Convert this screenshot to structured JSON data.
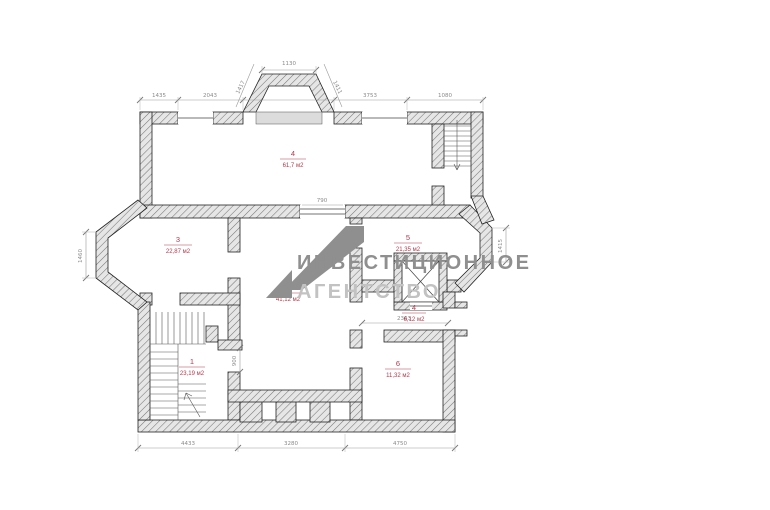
{
  "document": {
    "type": "architectural floor plan drawing",
    "units_note": "м2"
  },
  "watermark": {
    "line1": "ИНВЕСТИЦИОННОЕ",
    "line2": "АГЕНТСТВО",
    "logo": "stylized-A-mark"
  },
  "rooms": [
    {
      "number": "4",
      "area": "61,7 м2"
    },
    {
      "number": "3",
      "area": "22,87 м2"
    },
    {
      "number": "2",
      "area": "41,12 м2"
    },
    {
      "number": "5",
      "area": "21,35 м2"
    },
    {
      "number": "4",
      "area": "6,12 м2"
    },
    {
      "number": "6",
      "area": "11,32 м2"
    },
    {
      "number": "1",
      "area": "23,19 м2"
    }
  ],
  "dimensions": [
    {
      "text": "1130",
      "x": 289,
      "y": 65,
      "rotate": 0
    },
    {
      "text": "1417",
      "x": 242,
      "y": 88,
      "rotate": -64
    },
    {
      "text": "1411",
      "x": 336,
      "y": 88,
      "rotate": 64
    },
    {
      "text": "1435",
      "x": 159,
      "y": 97,
      "rotate": 0
    },
    {
      "text": "2043",
      "x": 210,
      "y": 97,
      "rotate": 0
    },
    {
      "text": "3753",
      "x": 370,
      "y": 97,
      "rotate": 0
    },
    {
      "text": "1080",
      "x": 445,
      "y": 97,
      "rotate": 0
    },
    {
      "text": "4433",
      "x": 188,
      "y": 445,
      "rotate": 0
    },
    {
      "text": "3280",
      "x": 291,
      "y": 445,
      "rotate": 0
    },
    {
      "text": "4750",
      "x": 400,
      "y": 445,
      "rotate": 0
    },
    {
      "text": "1460",
      "x": 82,
      "y": 256,
      "rotate": -90
    },
    {
      "text": "1415",
      "x": 502,
      "y": 246,
      "rotate": -90
    },
    {
      "text": "2363",
      "x": 404,
      "y": 320,
      "rotate": 0
    },
    {
      "text": "900",
      "x": 236,
      "y": 361,
      "rotate": -90
    },
    {
      "text": "790",
      "x": 322,
      "y": 202,
      "rotate": 0
    }
  ],
  "colors": {
    "wall_fill": "#e6e6e6",
    "wall_hatch": "#777777",
    "wall_outline": "#222222",
    "room_label": "#b5394a",
    "dimension": "#8a8a8a",
    "watermark_dark": "#8f8f8f",
    "watermark_light": "#c2c2c2",
    "background": "#ffffff"
  }
}
